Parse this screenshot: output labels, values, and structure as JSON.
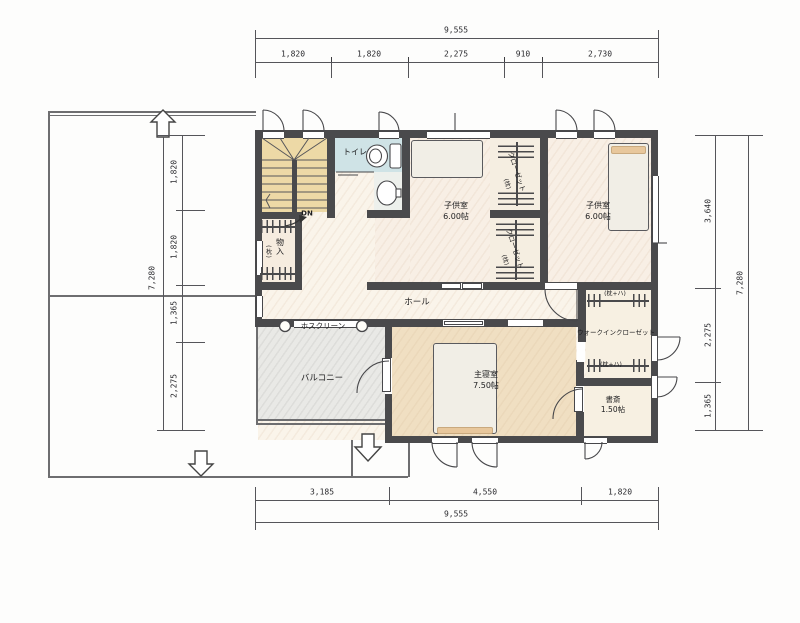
{
  "plan": {
    "rooms": {
      "toilet": {
        "label": "トイレ"
      },
      "stairs": {
        "dn": "DN"
      },
      "storage": {
        "label": "物入",
        "note": "(枕)"
      },
      "child_room_1": {
        "label": "子供室",
        "size": "6.00帖"
      },
      "child_room_2": {
        "label": "子供室",
        "size": "6.00帖"
      },
      "closet_upper": {
        "label": "クローゼット",
        "note": "(枕)"
      },
      "closet_lower": {
        "label": "クローゼット",
        "note": "(枕)"
      },
      "hall": {
        "label": "ホール"
      },
      "hosclean": {
        "label": "ホスクリーン"
      },
      "balcony": {
        "label": "バルコニー"
      },
      "master_bedroom": {
        "label": "主寝室",
        "size": "7.50帖"
      },
      "wic": {
        "label": "ウォークインクローゼット",
        "shelf_top": "(枕+ハ)",
        "shelf_bottom": "(枕+ハ)"
      },
      "study": {
        "label": "書斎",
        "size": "1.50帖"
      }
    },
    "dims": {
      "top_total": "9,555",
      "top_segments": [
        "1,820",
        "1,820",
        "2,275",
        "910",
        "2,730"
      ],
      "bottom_total": "9,555",
      "bottom_segments": [
        "3,185",
        "4,550",
        "1,820"
      ],
      "left_total": "7,280",
      "left_segments": [
        "1,820",
        "1,820",
        "1,365",
        "2,275"
      ],
      "right_total": "7,280",
      "right_segments": [
        "3,640",
        "2,275",
        "1,365"
      ]
    },
    "colors": {
      "wall": "#4a4a4c",
      "stairs_floor": "#edd9a6",
      "toilet_floor": "#cfe3e6",
      "bedroom_floor": "#f0dfc2",
      "balcony_floor": "#e9e9e6",
      "dim_line": "#55555a"
    }
  }
}
